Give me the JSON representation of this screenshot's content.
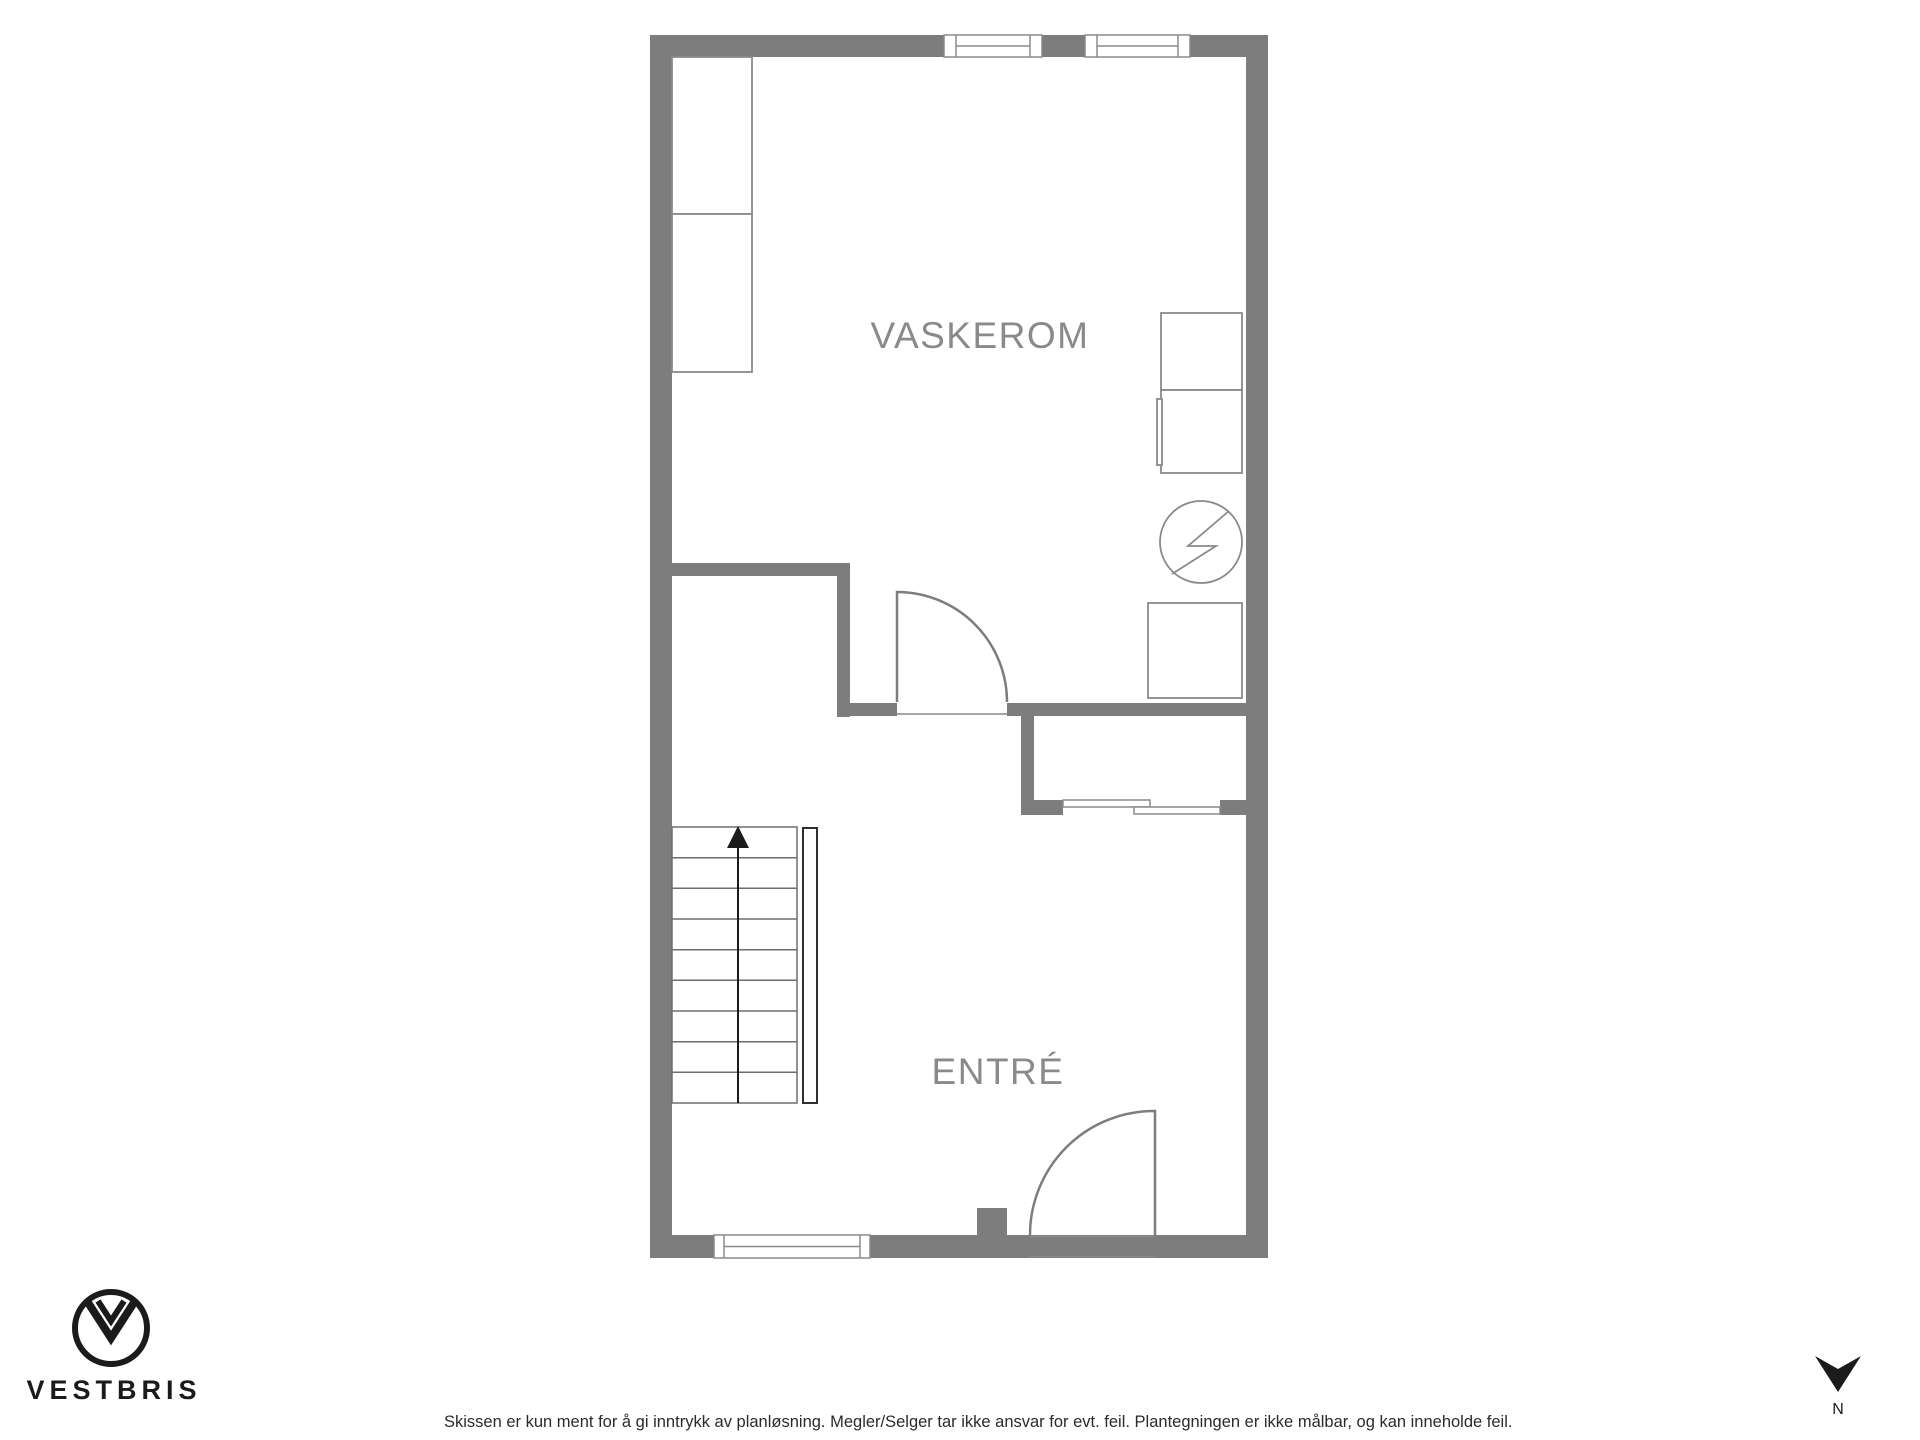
{
  "rooms": {
    "vaskerom": {
      "label": "VASKEROM"
    },
    "entre": {
      "label": "ENTRÉ"
    }
  },
  "branding": {
    "name": "VESTBRIS"
  },
  "footer": {
    "disclaimer": "Skissen er kun ment for å gi inntrykk av planløsning. Megler/Selger tar ikke ansvar for evt. feil. Plantegningen er ikke målbar, og kan inneholde feil."
  },
  "compass": {
    "north_label": "N"
  },
  "icons": {
    "water_heater": "circle-lightning-bolt",
    "stair_direction": "arrow-up",
    "north": "dart-triangle-down",
    "logo": "double-chevron-in-circle"
  },
  "colors": {
    "wall": "#7d7d7d",
    "symbol": "#8a8a8a",
    "door": "#7d7d7d",
    "stair_line": "#6e6e6e",
    "stair_rail": "#2f2f2f",
    "ink": "#1b1b1b",
    "room_label": "#8a8a8a",
    "disclaimer": "#2b2b2b"
  }
}
